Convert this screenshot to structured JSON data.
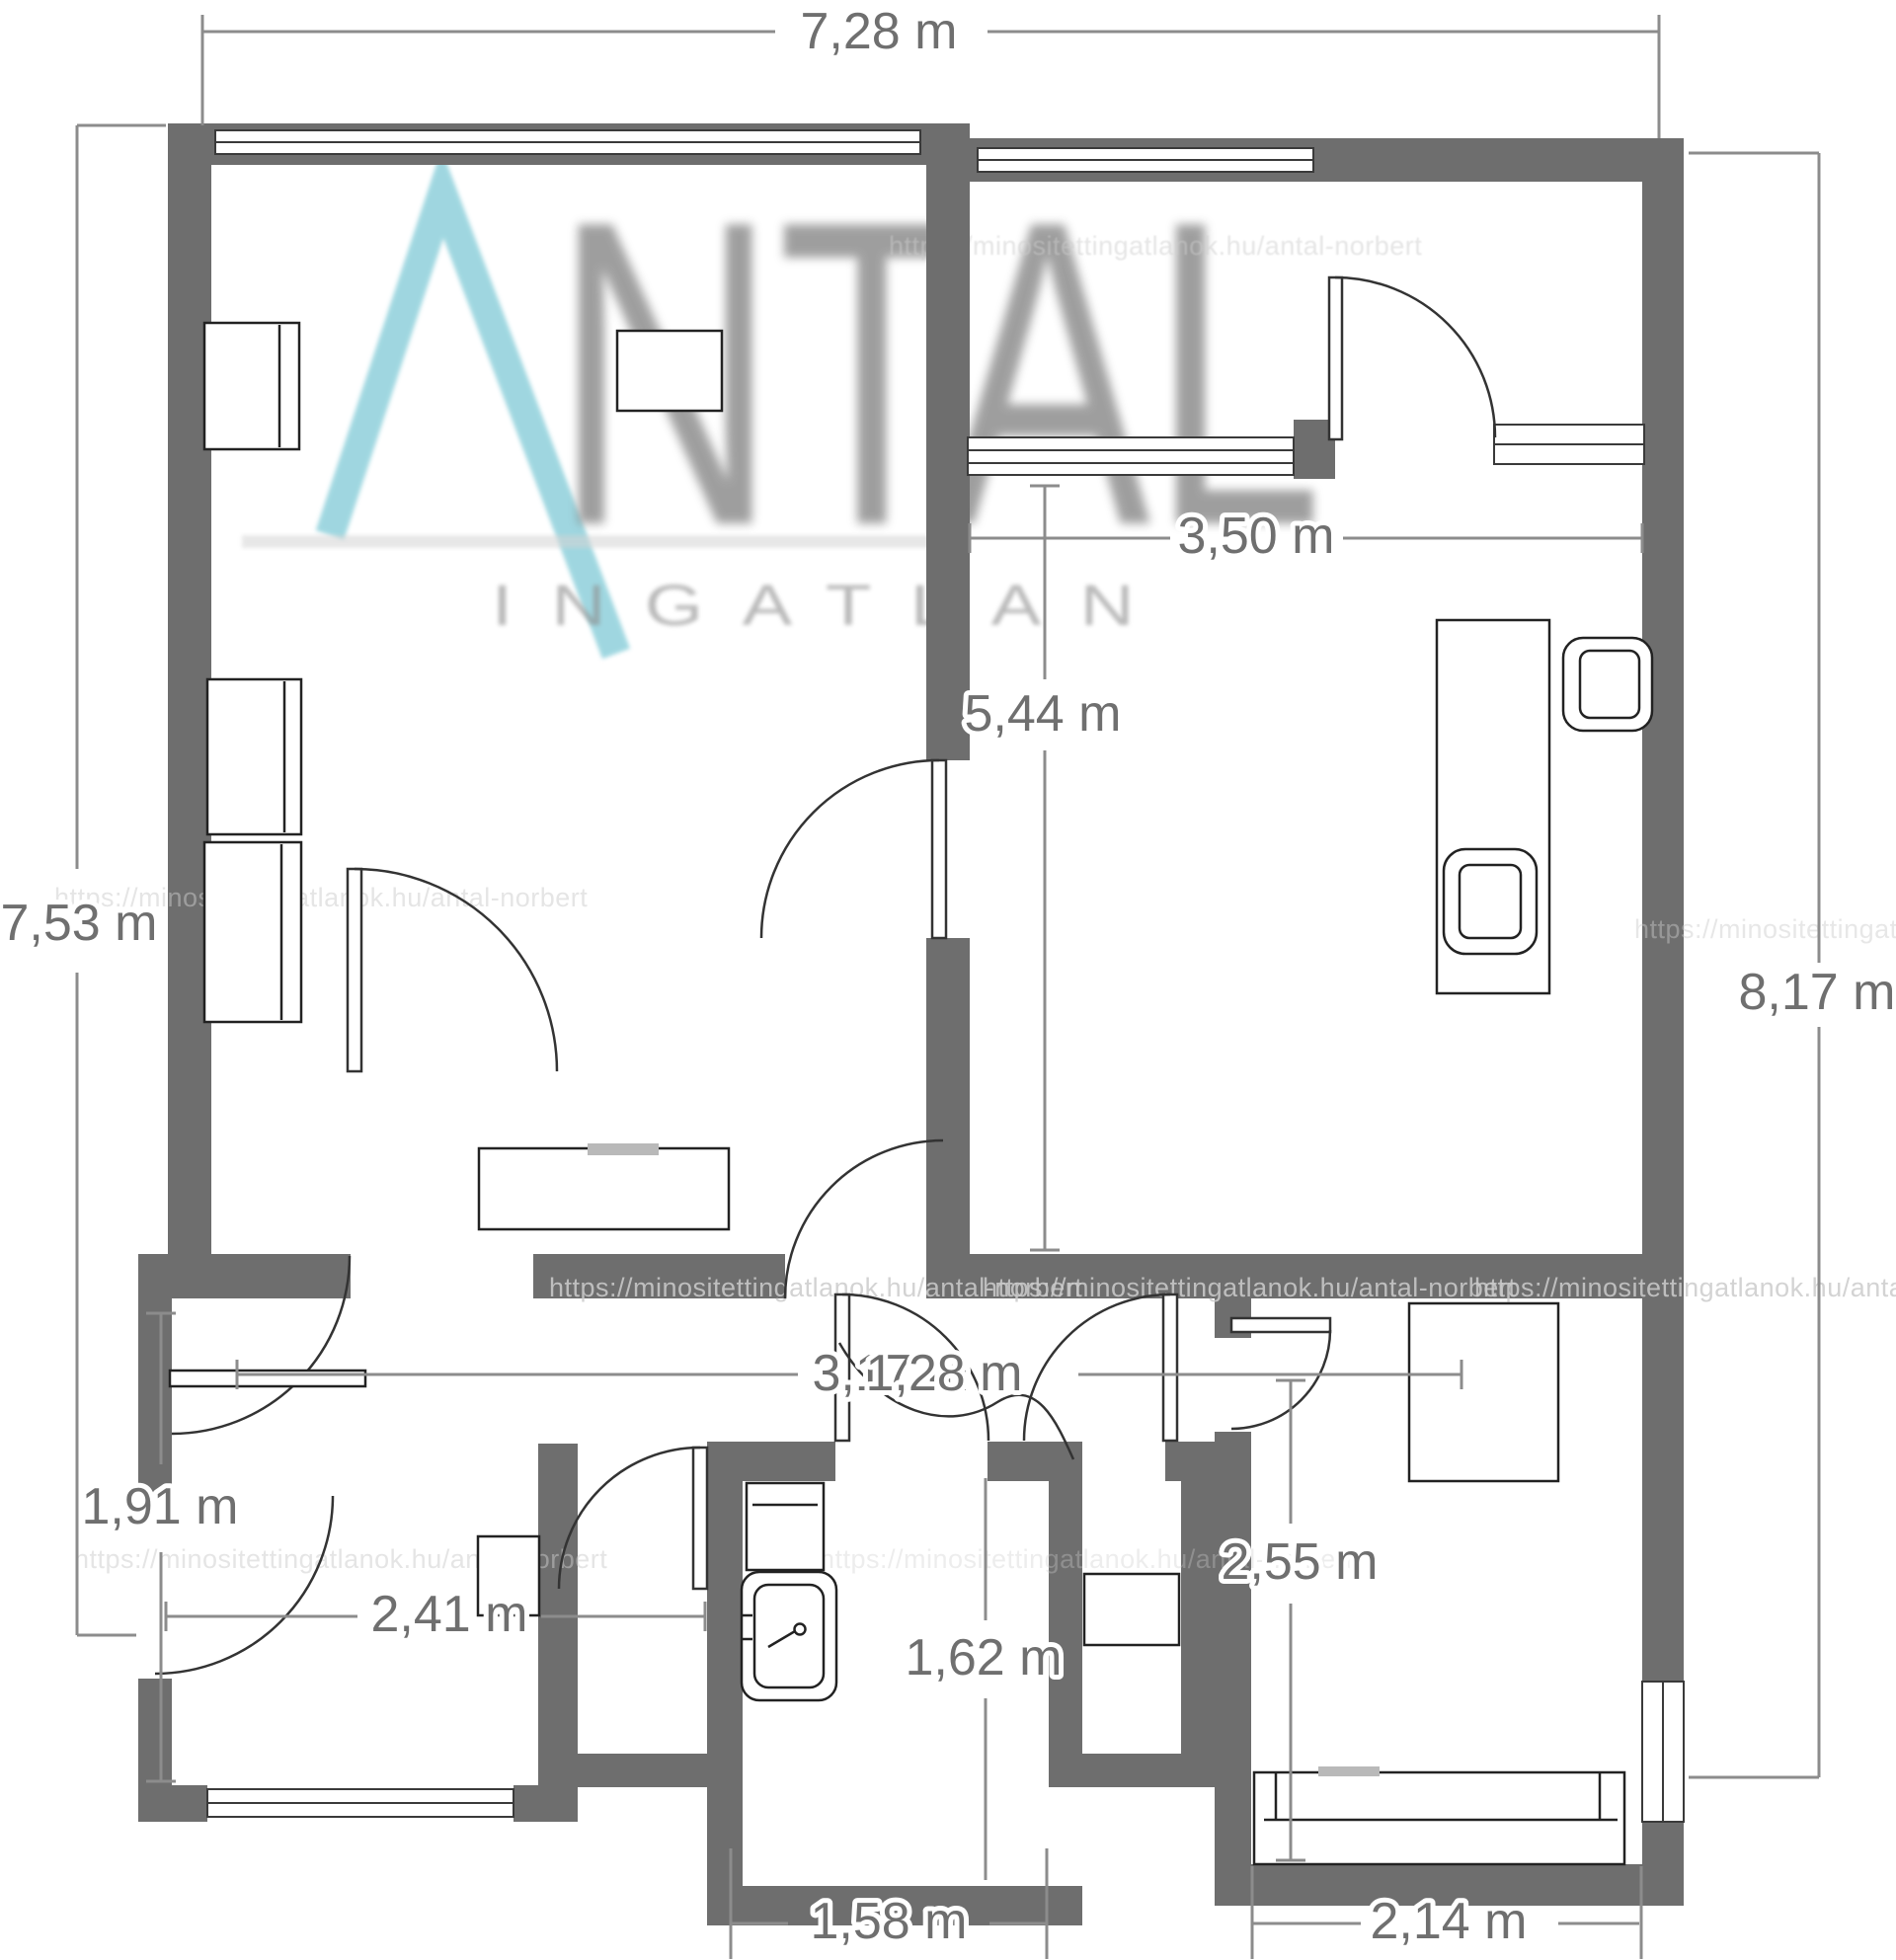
{
  "brand": {
    "logo_letters": "NTAL",
    "logo_subtitle": "INGATLAN",
    "watermark_url": "https://minositettingatlanok.hu/antal-norbert"
  },
  "dimensions": {
    "total_width_top": "7,28 m",
    "total_height_left": "7,53 m",
    "total_height_right": "8,17 m",
    "bedroom_width": "3,50 m",
    "bedroom_height": "5,44 m",
    "hallway_width": "3,17 m",
    "hallway_width_overlap": "1,28 m",
    "entry_height": "1,91 m",
    "entry_width": "2,41 m",
    "room_bottom_right_height": "2,55 m",
    "bathroom_height": "1,62 m",
    "bathroom_width": "1,58 m",
    "room_bottom_right_width": "2,14 m"
  },
  "colors": {
    "wall": "#6e6e6e",
    "dimension_line": "#8c8c8c",
    "dimension_text": "#6f6f6f",
    "furniture_line": "#222222",
    "logo_teal": "#8fd0db",
    "logo_gray": "#7a7a7a",
    "watermark_text": "#cccccc"
  }
}
